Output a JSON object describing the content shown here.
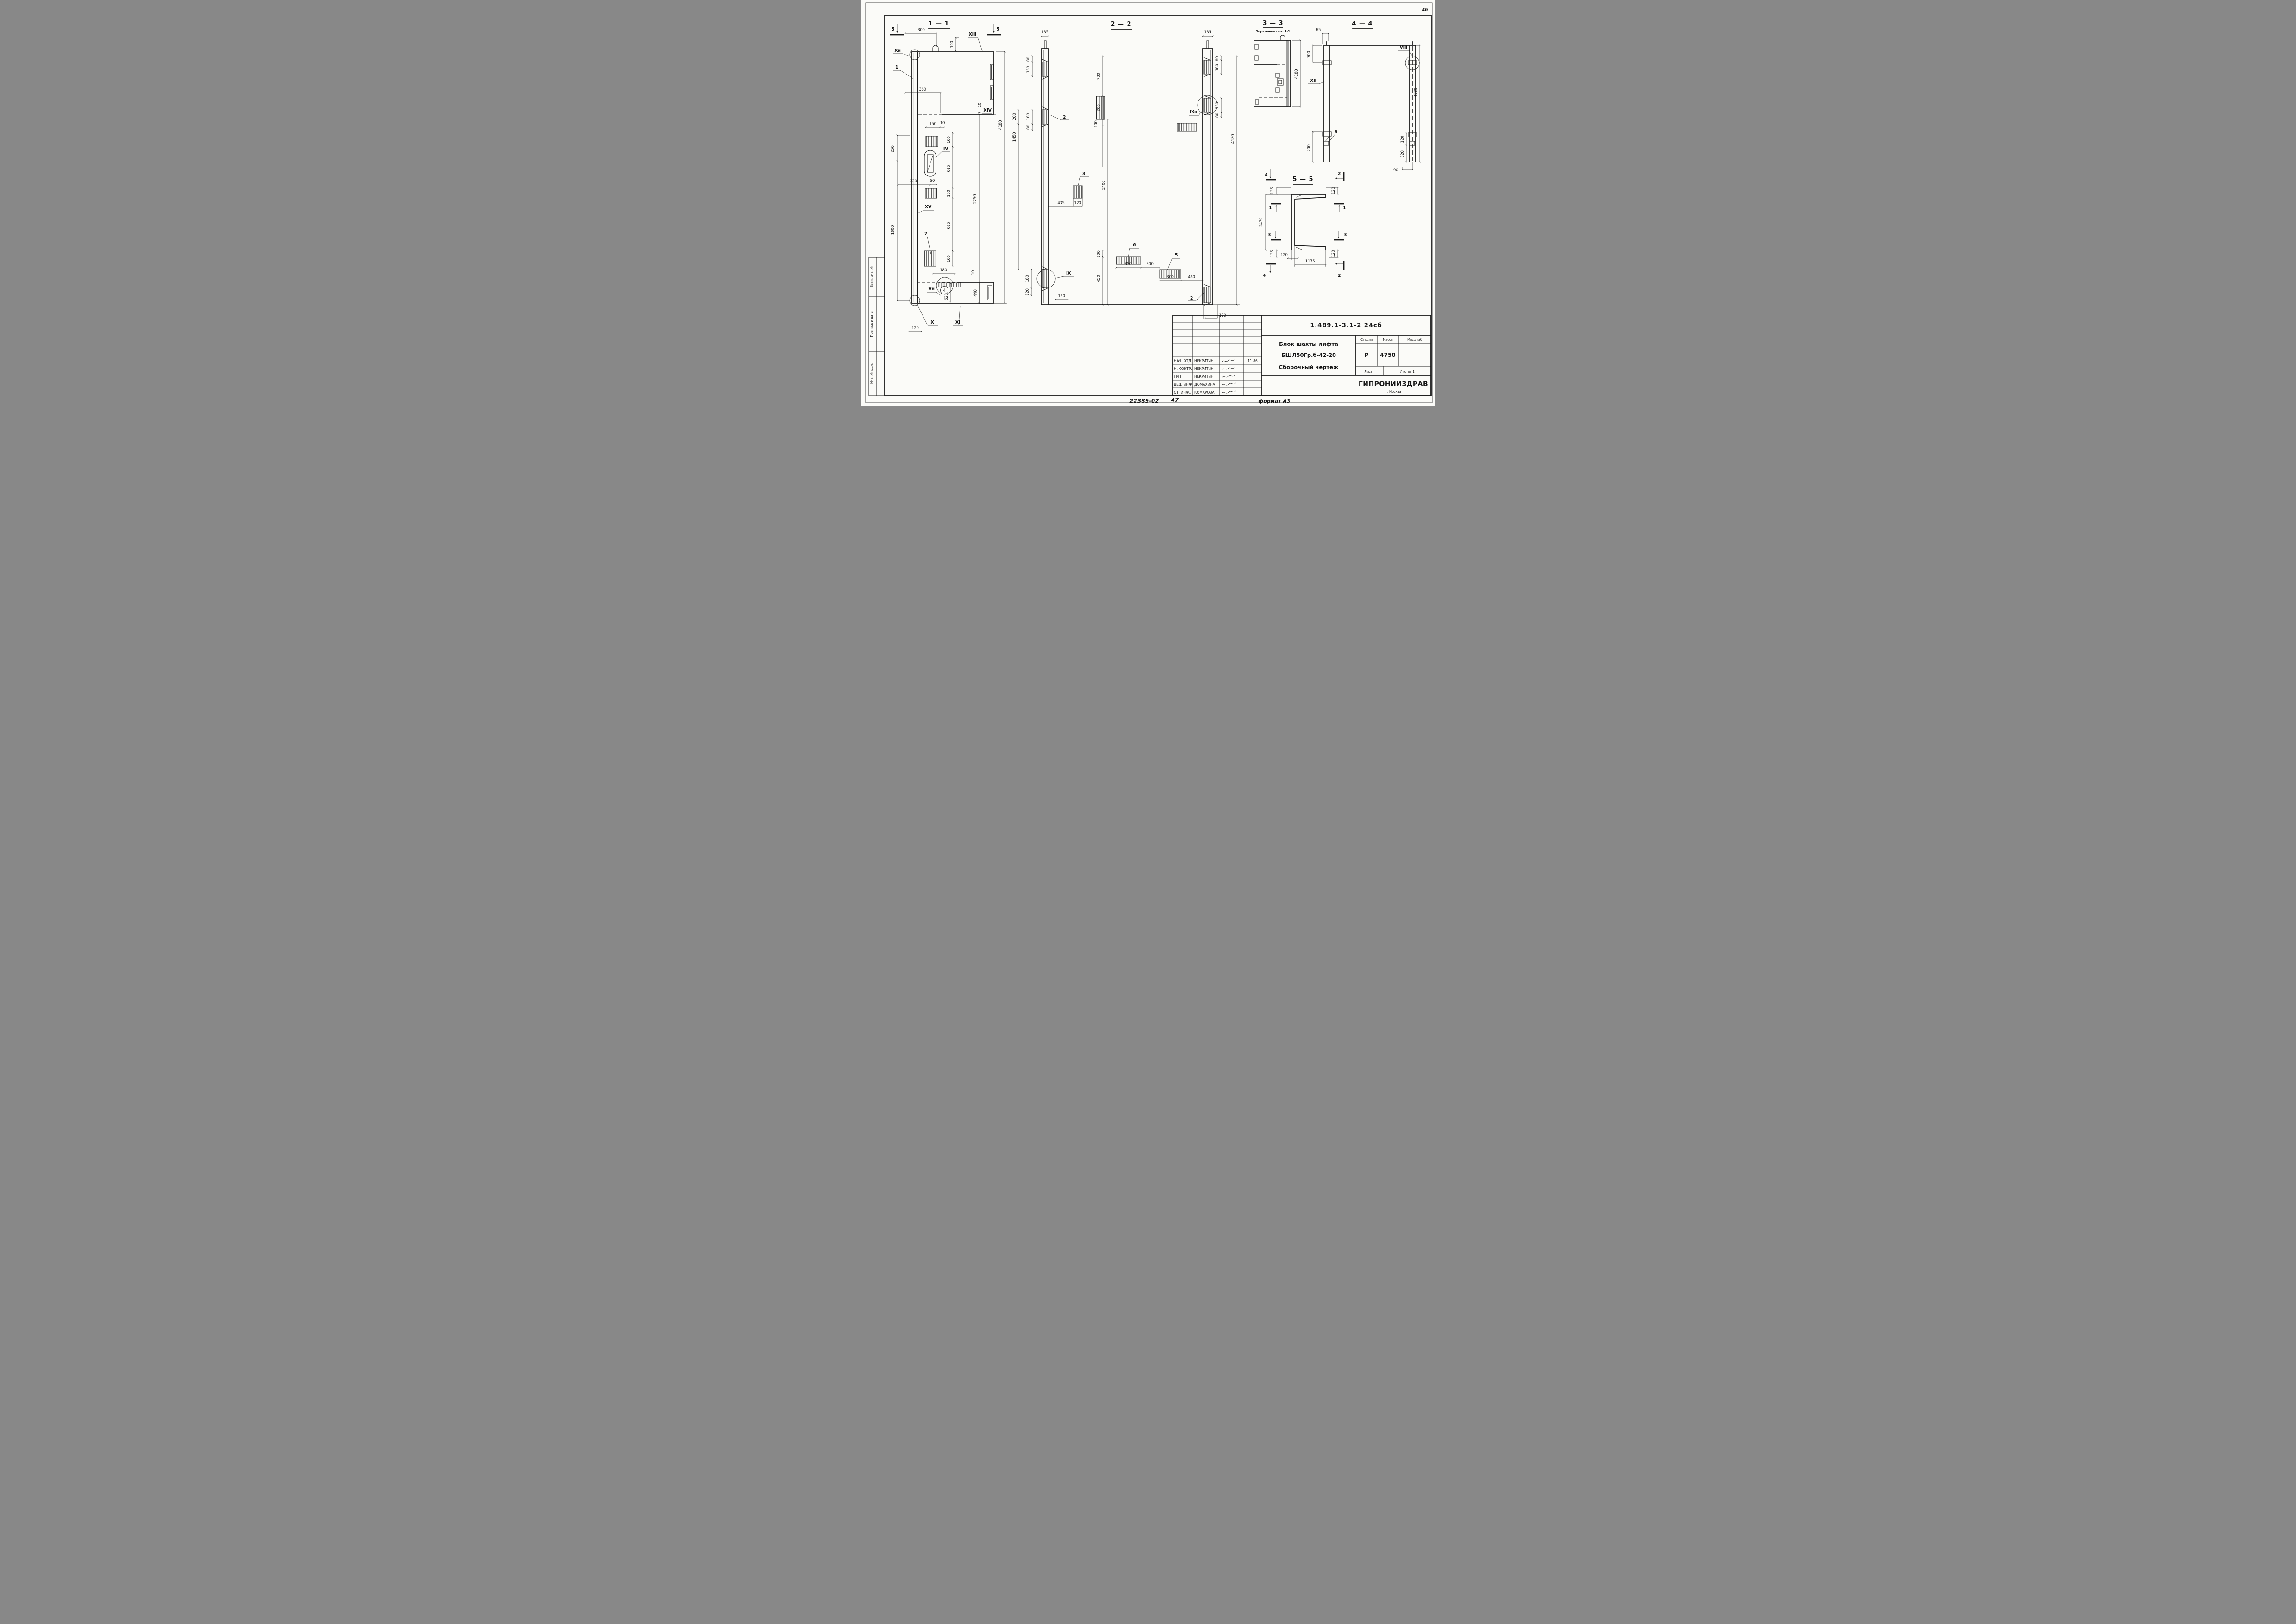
{
  "page": {
    "sheet_no": "46",
    "stamp_doc": "22389-02",
    "stamp_sheet": "47",
    "format_label": "формат А3"
  },
  "side_stamp": {
    "rows": [
      "Взам. инв. №",
      "Подпись и дата",
      "Инв. №подл."
    ]
  },
  "s11": {
    "title": "1 — 1",
    "cut": "5",
    "d": [
      "300",
      "100",
      "XIII",
      "Xн",
      "1",
      "360",
      "XIV",
      "10",
      "150",
      "10",
      "160",
      "IV",
      "615",
      "250",
      "220",
      "50",
      "160",
      "2250",
      "4180",
      "XV",
      "615",
      "1800",
      "7",
      "160",
      "180",
      "10",
      "Vн",
      "4",
      "620",
      "440",
      "X",
      "XI",
      "120"
    ]
  },
  "s22": {
    "title": "2 — 2",
    "d": [
      "135",
      "80",
      "180",
      "180",
      "80",
      "730",
      "2",
      "200",
      "100",
      "2400",
      "3",
      "435",
      "120",
      "200",
      "1450",
      "IX",
      "180",
      "120",
      "120",
      "100",
      "450",
      "6",
      "350",
      "300",
      "5",
      "300",
      "460",
      "2",
      "120",
      "4180",
      "135",
      "80",
      "180",
      "IXн",
      "180",
      "80"
    ]
  },
  "s33": {
    "title": "3 — 3",
    "subtitle": "Зеркально сеч. 1-1",
    "d": [
      "4180"
    ]
  },
  "s44": {
    "title": "4 — 4",
    "d": [
      "65",
      "700",
      "VIII",
      "XII",
      "4180",
      "8",
      "700",
      "120",
      "320",
      "90"
    ]
  },
  "s55": {
    "title": "5 — 5",
    "marks": {
      "m1": "1",
      "m2": "2",
      "m3": "3",
      "m4": "4"
    },
    "d": [
      "135",
      "120",
      "2470",
      "135",
      "120",
      "120",
      "1175"
    ]
  },
  "title_block": {
    "doc_number": "1.489.1-3.1-2  24сб",
    "product": "Блок шахты лифта",
    "product2": "БШЛ50Гр.б-42-20",
    "doc_type": "Сборочный чертеж",
    "h_stage": "Стадия",
    "h_mass": "Масса",
    "h_scale": "Масштаб",
    "stage": "Р",
    "mass": "4750",
    "scale": "",
    "h_sheet": "Лист",
    "h_sheets": "Листов 1",
    "org": "ГИПРОНИИЗДРАВ",
    "org_city": "г. Москва",
    "rows": [
      {
        "role": "НАЧ. ОТД.",
        "name": "НЕКРИТИН",
        "date": "11 86"
      },
      {
        "role": "Н. КОНТР.",
        "name": "НЕКРИТИН",
        "date": ""
      },
      {
        "role": "ГИП",
        "name": "НЕКРИТИН",
        "date": ""
      },
      {
        "role": "ВЕД. ИНЖ.",
        "name": "ДОМАХИНА",
        "date": ""
      },
      {
        "role": "СТ. ИНЖ.",
        "name": "КОМАРОВА",
        "date": ""
      }
    ]
  }
}
